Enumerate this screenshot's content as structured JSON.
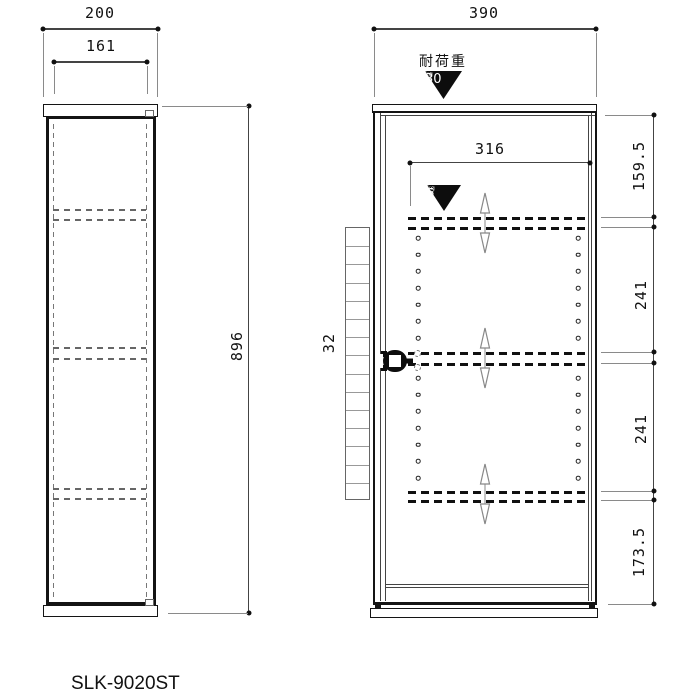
{
  "drawing": {
    "model_number": "SLK-9020ST",
    "side_view": {
      "overall_width_mm": "200",
      "inner_width_mm": "161",
      "overall_height_mm": "896"
    },
    "front_view": {
      "overall_width_mm": "390",
      "inner_width_mm": "316",
      "side_rail_offset_mm": "32",
      "height_segments_mm": [
        "159.5",
        "241",
        "241",
        "173.5"
      ],
      "load_capacity": {
        "label": "耐荷重",
        "value": "30",
        "unit": "kg"
      },
      "shelf_load_capacity": {
        "value": "5",
        "unit": "kg"
      },
      "pin_holes_per_column": 7,
      "pin_hole_columns": 2,
      "rail_slots": 15,
      "adjustable_shelf_count": 3
    }
  }
}
